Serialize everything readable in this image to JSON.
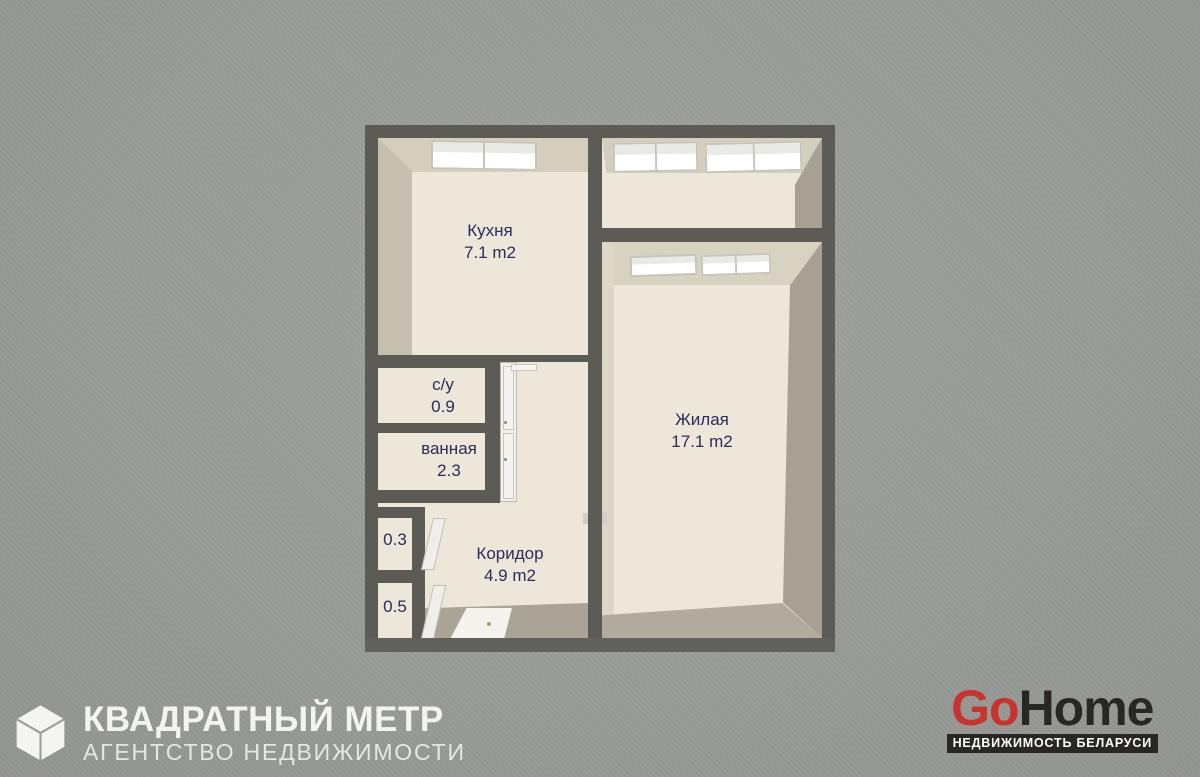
{
  "background_color": "#9c9e9a",
  "plan": {
    "colors": {
      "wall": "#5d5b56",
      "floor": "#ece7d8",
      "face_top": "#d4cebc",
      "face_side": "#c6c0ae",
      "face_dark": "#a7a194",
      "window": "#fbfbf8",
      "label_text": "#2b2b5e"
    },
    "rooms": {
      "kitchen": {
        "label": "Кухня",
        "area": "7.1 m2"
      },
      "living": {
        "label": "Жилая",
        "area": "17.1 m2"
      },
      "corridor": {
        "label": "Коридор",
        "area": "4.9 m2"
      },
      "wc": {
        "label": "с/у",
        "area": "0.9"
      },
      "bathroom": {
        "label": "ванная",
        "area": "2.3"
      },
      "closet_small": {
        "area": "0.3"
      },
      "closet_large": {
        "area": "0.5"
      }
    }
  },
  "footer": {
    "agency": {
      "title": "КВАДРАТНЫЙ МЕТР",
      "subtitle": "АГЕНТСТВО НЕДВИЖИМОСТИ"
    },
    "gohome": {
      "part1": "Go",
      "part2": "Home",
      "tagline": "НЕДВИЖИМОСТЬ БЕЛАРУСИ",
      "accent_color": "#c8332e",
      "dark_color": "#282724"
    }
  }
}
